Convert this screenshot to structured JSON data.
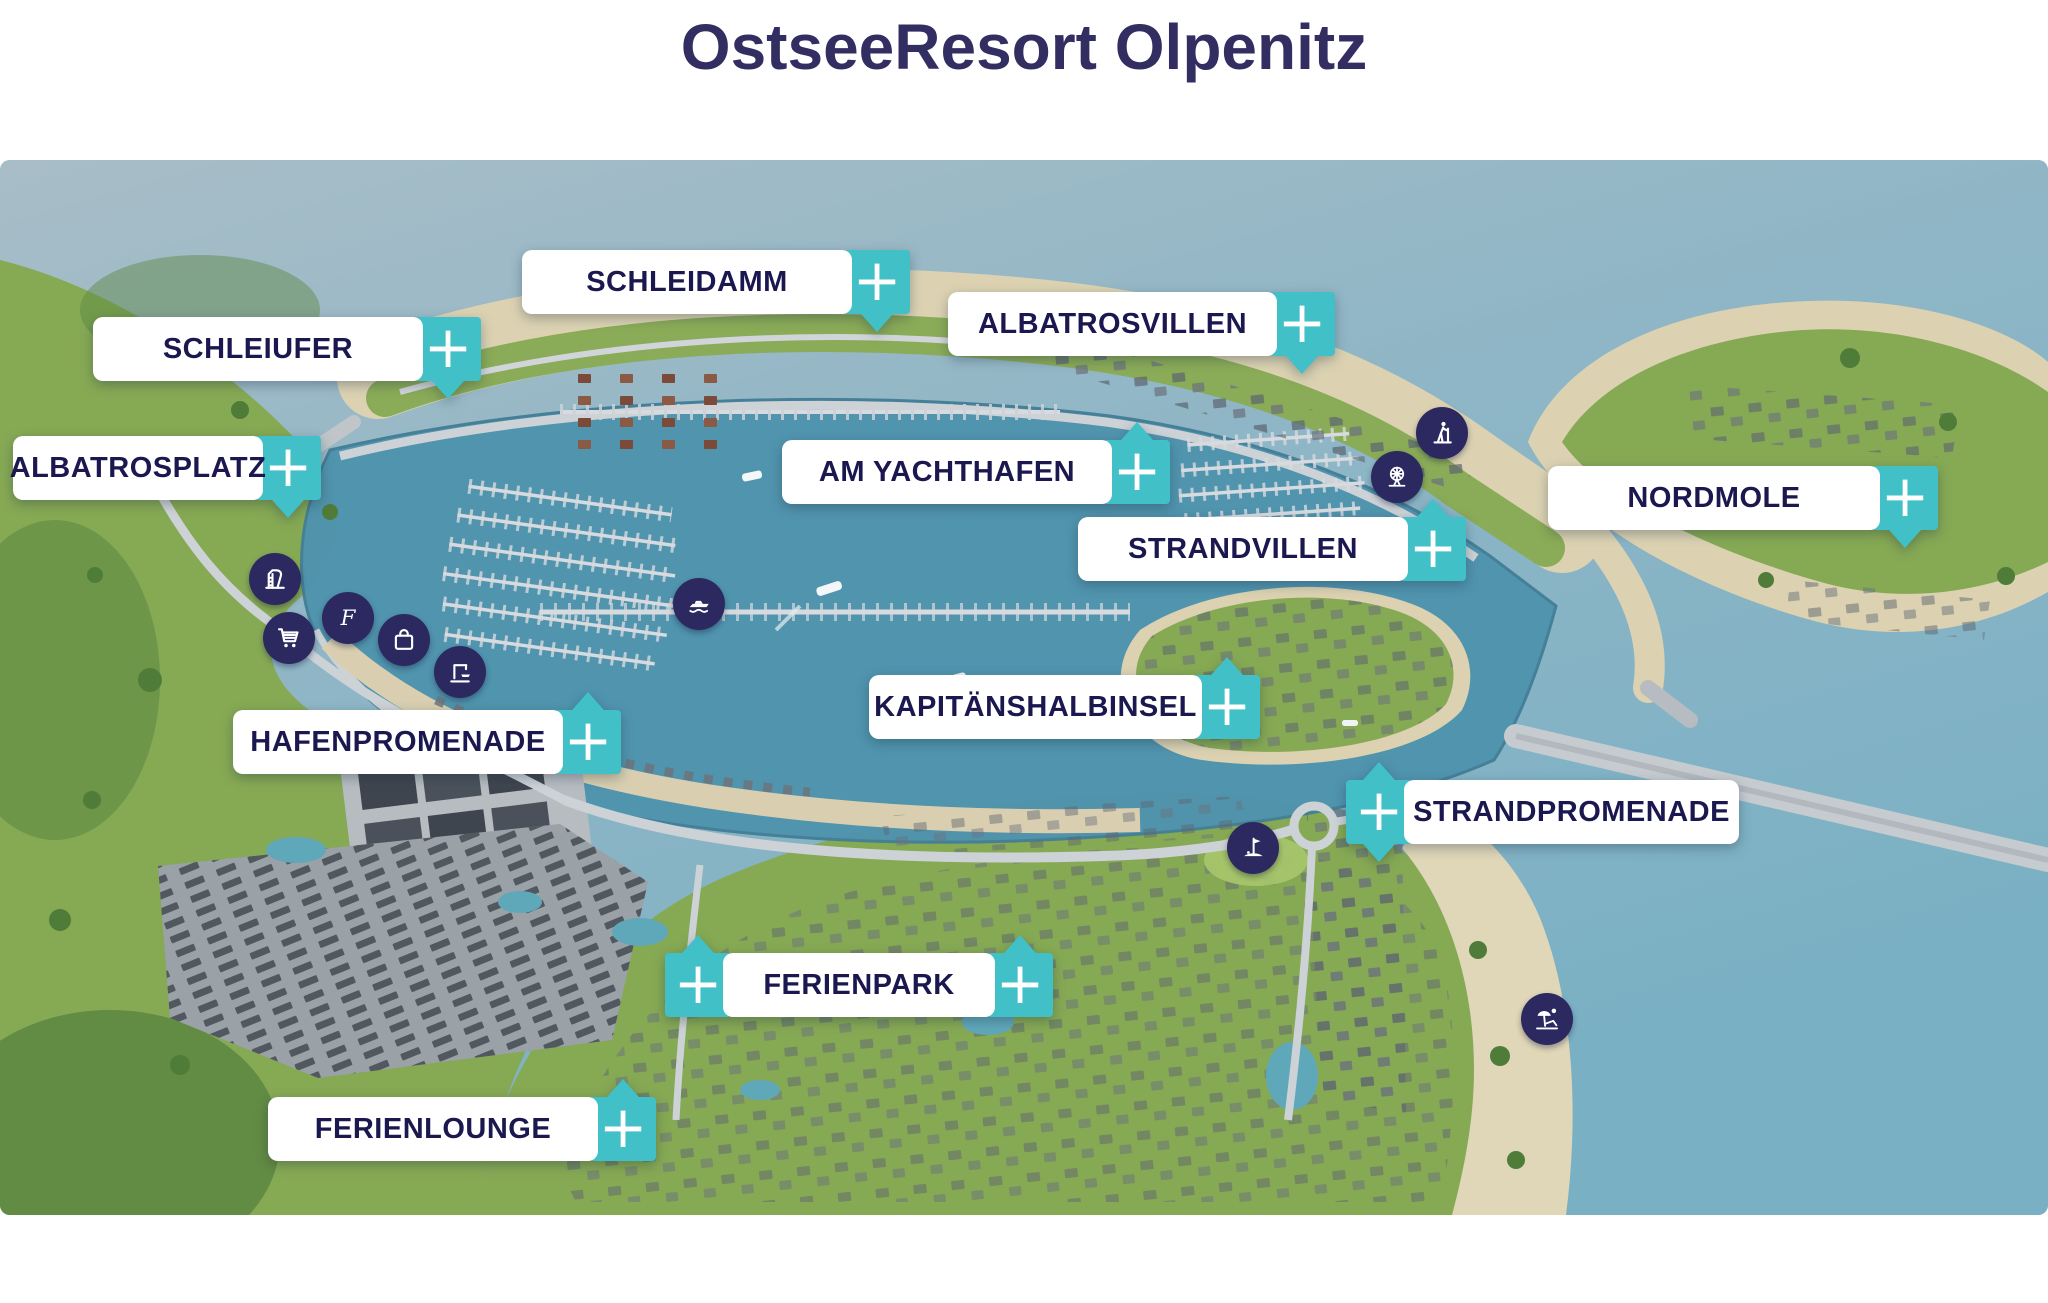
{
  "title": "OstseeResort Olpenitz",
  "plus_label": "+",
  "colors": {
    "accent_teal": "#41c0c7",
    "label_text_navy": "#1b1850",
    "title_navy": "#322e62",
    "icon_circle_navy": "#2b2960",
    "harbor_water": "#4f93ae",
    "open_sea": "#8fb6c6",
    "land_green": "#86a954",
    "sand": "#dcd2b2"
  },
  "labels": [
    {
      "id": "schleidamm",
      "text": "SCHLEIDAMM"
    },
    {
      "id": "schleiufer",
      "text": "SCHLEIUFER"
    },
    {
      "id": "albatrosvillen",
      "text": "ALBATROSVILLEN"
    },
    {
      "id": "albatrosplatz",
      "text": "ALBATROSPLATZ"
    },
    {
      "id": "am-yachthafen",
      "text": "AM YACHTHAFEN"
    },
    {
      "id": "nordmole",
      "text": "NORDMOLE"
    },
    {
      "id": "strandvillen",
      "text": "STRANDVILLEN"
    },
    {
      "id": "hafenpromenade",
      "text": "HAFENPROMENADE"
    },
    {
      "id": "kapitaenshalbinsel",
      "text": "KAPITÄNSHALBINSEL"
    },
    {
      "id": "strandpromenade",
      "text": "STRANDPROMENADE"
    },
    {
      "id": "ferienpark",
      "text": "FERIENPARK"
    },
    {
      "id": "ferienlounge",
      "text": "FERIENLOUNGE"
    }
  ],
  "icons": [
    "water-slide-icon",
    "shopping-cart-icon",
    "letter-f-icon",
    "shopping-bag-icon",
    "boat-crane-icon",
    "motor-yacht-icon",
    "hiking-icon",
    "amusement-park-icon",
    "minigolf-icon",
    "beach-icon"
  ]
}
